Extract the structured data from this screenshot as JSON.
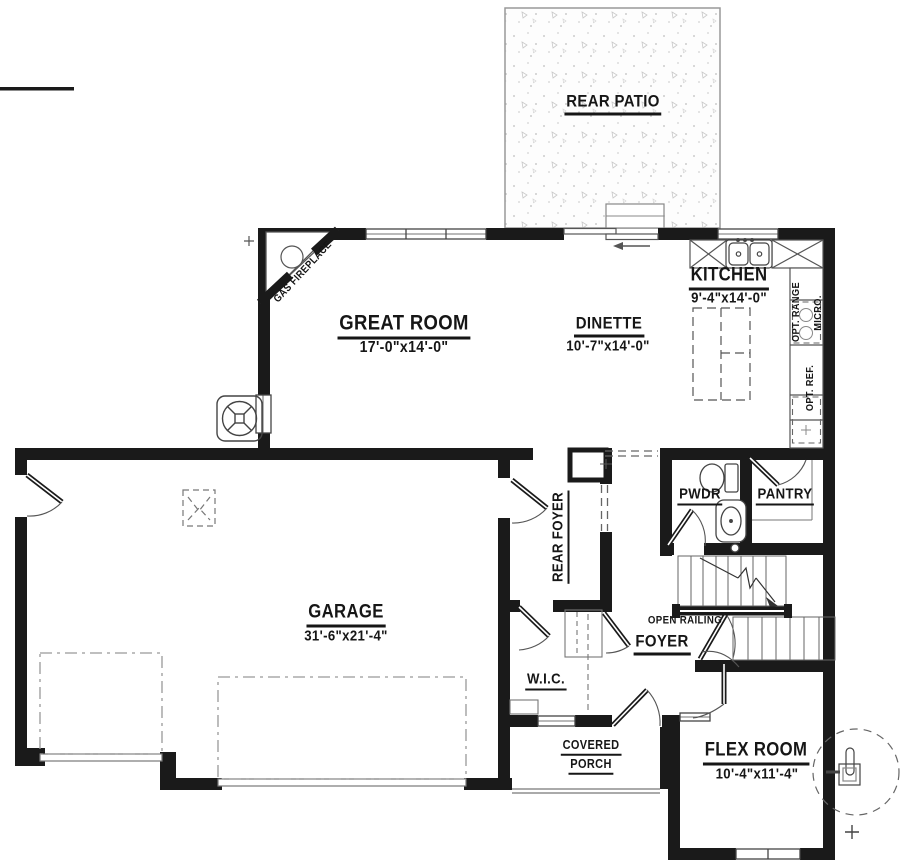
{
  "rooms": {
    "rear_patio": {
      "label": "REAR PATIO"
    },
    "great_room": {
      "label": "GREAT ROOM",
      "dims": "17'-0\"x14'-0\""
    },
    "dinette": {
      "label": "DINETTE",
      "dims": "10'-7\"x14'-0\""
    },
    "kitchen": {
      "label": "KITCHEN",
      "dims": "9'-4\"x14'-0\""
    },
    "garage": {
      "label": "GARAGE",
      "dims": "31'-6\"x21'-4\""
    },
    "rear_foyer": {
      "label": "REAR FOYER"
    },
    "pwdr": {
      "label": "PWDR"
    },
    "pantry": {
      "label": "PANTRY"
    },
    "foyer": {
      "label": "FOYER"
    },
    "wic": {
      "label": "W.I.C."
    },
    "covered_porch": {
      "label_line1": "COVERED",
      "label_line2": "PORCH"
    },
    "flex_room": {
      "label": "FLEX ROOM",
      "dims": "10'-4\"x11'-4\""
    }
  },
  "annotations": {
    "gas_fireplace": "GAS FIREPLACE",
    "open_railing": "OPEN RAILING",
    "opt_range": "OPT. RANGE",
    "micro": "MICRO.",
    "opt_ref": "OPT. REF."
  },
  "colors": {
    "wall": "#1a1a1a",
    "thin_line": "#555555",
    "patio_dot": "#cccccc"
  }
}
